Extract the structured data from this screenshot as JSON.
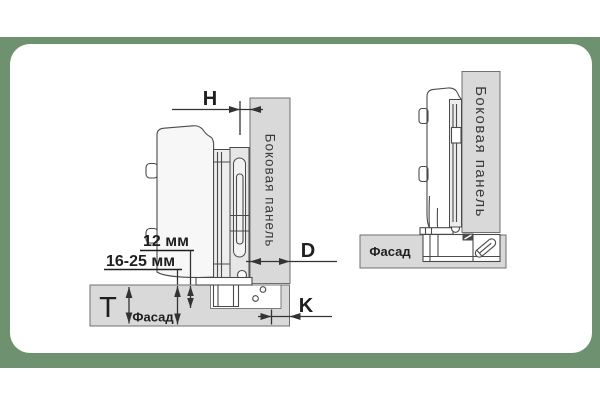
{
  "frame": {
    "page_background": "#ffffff",
    "border_color": "#6e9270",
    "card_color": "#ffffff"
  },
  "colors": {
    "panel_fill": "#d9d9d9",
    "panel_stroke": "#6f6f6f",
    "cup_fill": "#ffffff",
    "line": "#4a4a4a",
    "dim_line": "#333333",
    "text": "#1f1f1f",
    "panel_text": "#3a3a3a"
  },
  "left_diagram": {
    "labels": {
      "h": "H",
      "cup_depth": "12 мм",
      "facade_thickness": "16-25 мм",
      "t": "T",
      "d": "D",
      "k": "K",
      "side_panel": "Боковая панель",
      "facade": "Фасад"
    }
  },
  "right_diagram": {
    "labels": {
      "side_panel": "Боковая панель",
      "facade": "Фасад"
    }
  }
}
